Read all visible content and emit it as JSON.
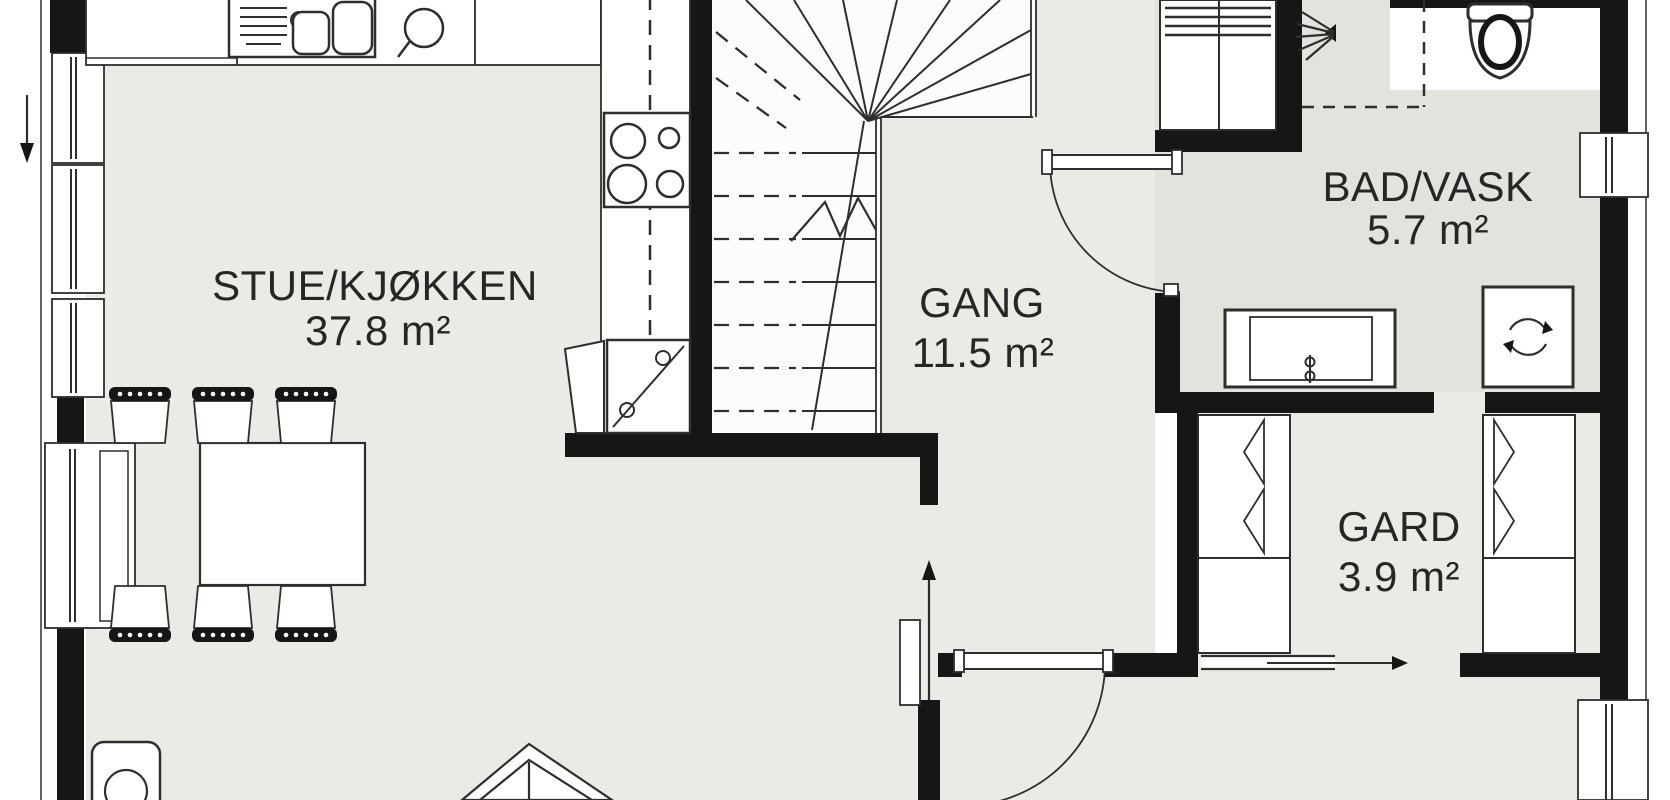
{
  "plan": {
    "title": "First floor plan",
    "rooms": [
      {
        "name": "STUE/KJØKKEN",
        "area": "37.8 m²"
      },
      {
        "name": "GANG",
        "area": "11.5 m²"
      },
      {
        "name": "BAD/VASK",
        "area": "5.7 m²"
      },
      {
        "name": "GARD",
        "area": "3.9 m²"
      }
    ],
    "colors": {
      "floor": "#eceae4",
      "floor_bad": "#e3e2dd",
      "wall": "#161616",
      "line": "#2e2e2e",
      "bg": "#ffffff"
    }
  }
}
